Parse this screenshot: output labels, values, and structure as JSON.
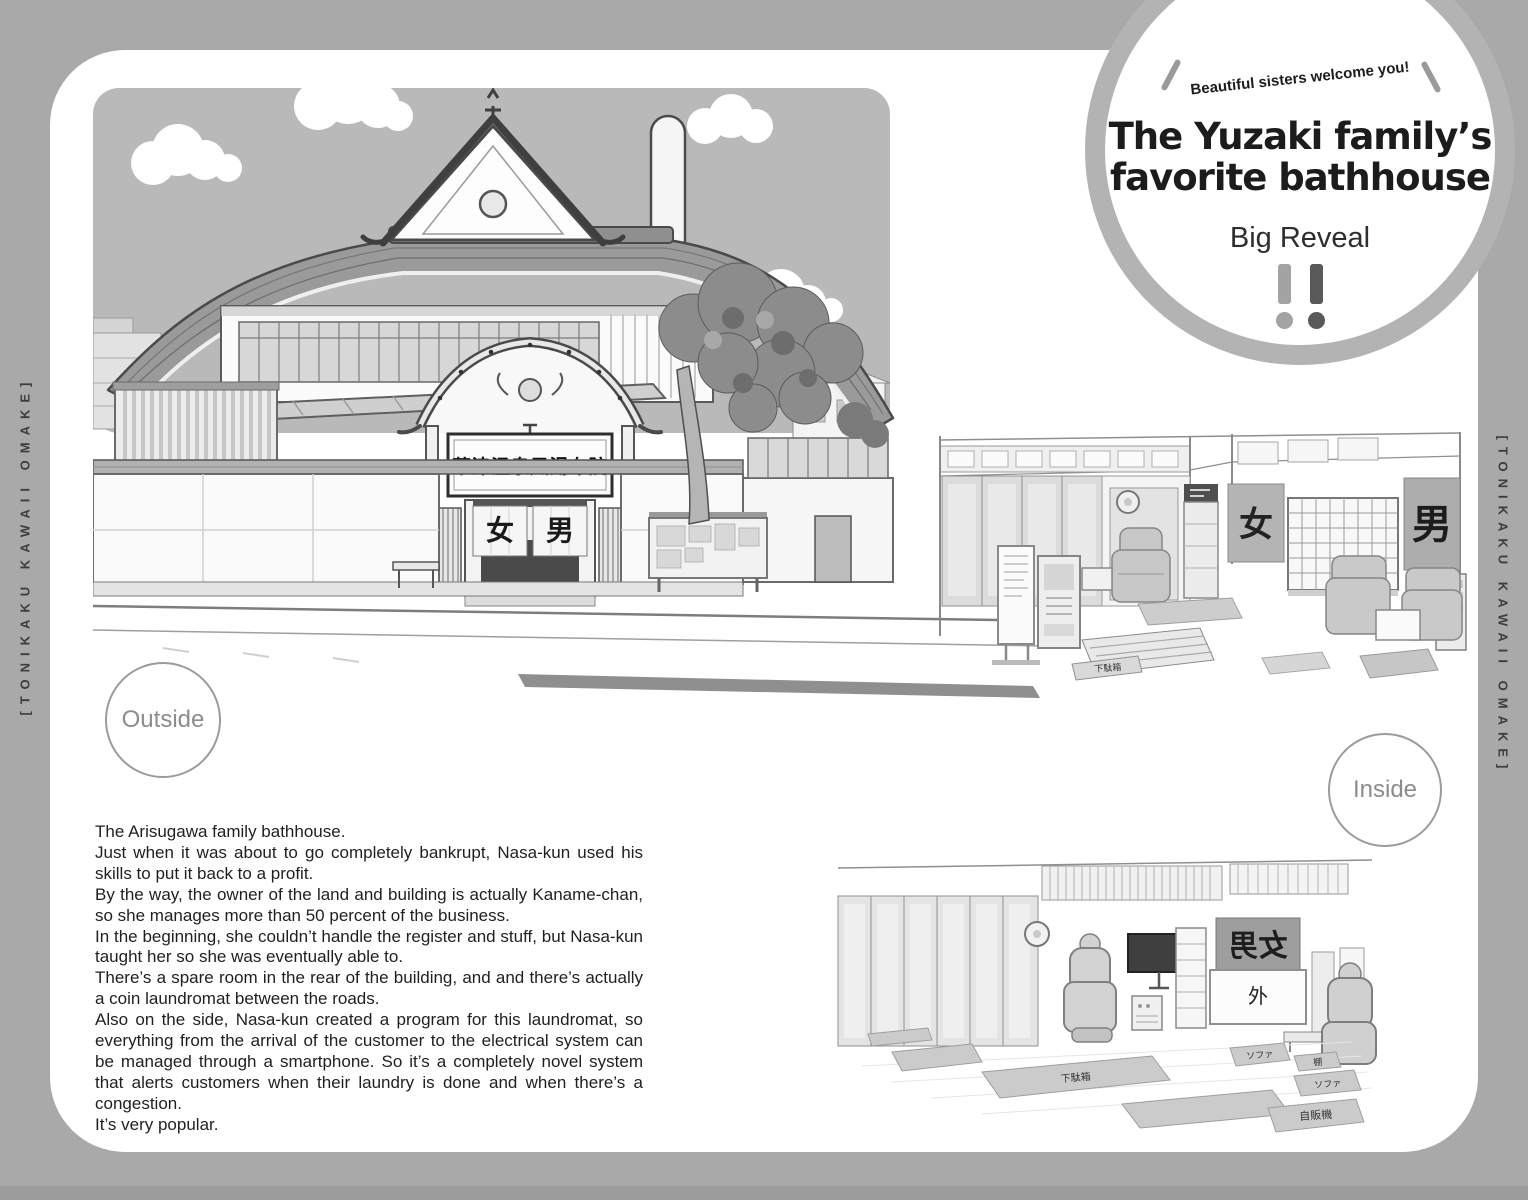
{
  "page": {
    "spine_left": "[TONIKAKU KAWAII OMAKE]",
    "spine_right": "[TONIKAKU KAWAII OMAKE]"
  },
  "badge": {
    "tagline": "Beautiful sisters welcome you!",
    "title_line1": "The Yuzaki family’s",
    "title_line2": "favorite bathhouse",
    "subtitle": "Big Reveal"
  },
  "labels": {
    "outside": "Outside",
    "inside": "Inside"
  },
  "exterior": {
    "sign": "草津温泉風湯布院",
    "curtain_left": "女",
    "curtain_right": "男"
  },
  "interior_lobby": {
    "curtain_left": "女",
    "curtain_right": "男",
    "step_label": "下駄箱"
  },
  "interior_lounge": {
    "curtain_back": "女男",
    "sign_outside": "外",
    "mat_sofa": "ソファ",
    "mat_shelf": "棚",
    "mat_vending": "自販機",
    "mat_shoe_rack": "下駄箱"
  },
  "body_text": {
    "lines": [
      "The Arisugawa family bathhouse.",
      "Just when it was about to go completely bankrupt, Nasa-kun used his skills to put it back to a profit.",
      "By the way, the owner of the land and building is actually Kaname-chan, so she manages more than 50 percent of the business.",
      "In the beginning, she couldn’t handle the register and stuff, but Nasa-kun taught her so she was eventually able to.",
      "There’s a spare room in the rear of the building, and and there’s actually a coin laundromat between the roads.",
      "Also on the side, Nasa-kun created a program for this laundromat, so everything from the arrival of the customer to the electrical system can be managed through a smartphone. So it’s a completely novel system that alerts customers when their laundry is done and when there’s a congestion.",
      "It’s very popular."
    ]
  },
  "colors": {
    "page_margin": "#a9a9a9",
    "panel": "#ffffff",
    "sky": "#b9b9b9",
    "badge_ring": "#b3b3b3",
    "ink": "#1d1d1d",
    "exclaim_left": "#a3a3a3",
    "exclaim_right": "#595959"
  }
}
